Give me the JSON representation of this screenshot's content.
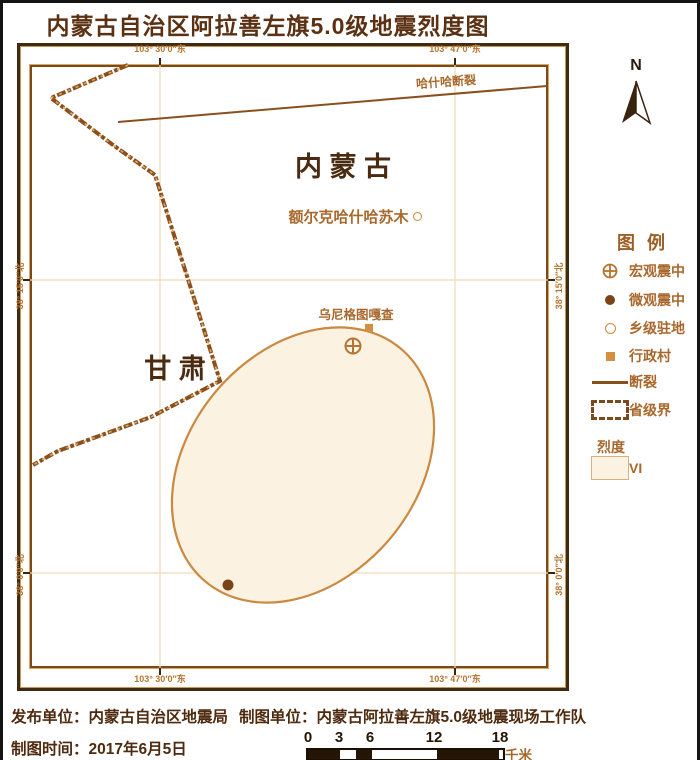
{
  "title": "内蒙古自治区阿拉善左旗5.0级地震烈度图",
  "colors": {
    "title_text": "#5c3012",
    "frame_dark": "#3f2a12",
    "frame_light": "#c89758",
    "boundary_line": "#8a4f1d",
    "gridline": "#f3d9b5",
    "intensity_vi_fill": "#fcf2e2",
    "intensity_vi_stroke": "#cb8840",
    "label_brown": "#a8682c",
    "footer_text": "#4e2a0e",
    "scalebar_dark": "#241505"
  },
  "map": {
    "north_label": "N",
    "region_inner_mongolia": "内 蒙 古",
    "region_gansu": "甘 肃",
    "fault_label": "哈什哈断裂",
    "township_label": "额尔克哈什哈苏木",
    "village_label": "乌尼格图嘎查",
    "coords": {
      "lon_left": "103° 30′0″东",
      "lon_right": "103° 47′0″东",
      "lat_upper": "38° 15′0″北",
      "lat_lower": "38° 0′0″北"
    }
  },
  "legend": {
    "title": "图例",
    "items": [
      {
        "symbol": "macro-epicenter",
        "label": "宏观震中"
      },
      {
        "symbol": "micro-epicenter",
        "label": "微观震中"
      },
      {
        "symbol": "township-seat",
        "label": "乡级驻地"
      },
      {
        "symbol": "village",
        "label": "行政村"
      },
      {
        "symbol": "fault",
        "label": "断裂"
      },
      {
        "symbol": "province-boundary",
        "label": "省级界"
      }
    ],
    "intensity_heading": "烈度",
    "intensity_value": "VI"
  },
  "footer": {
    "publisher": "发布单位：内蒙古自治区地震局",
    "mapper": "制图单位：内蒙古阿拉善左旗5.0级地震现场工作队",
    "date": "制图时间：2017年6月5日",
    "scalebar": {
      "ticks": [
        "0",
        "3",
        "6",
        "12",
        "18"
      ],
      "unit": "千米"
    }
  }
}
